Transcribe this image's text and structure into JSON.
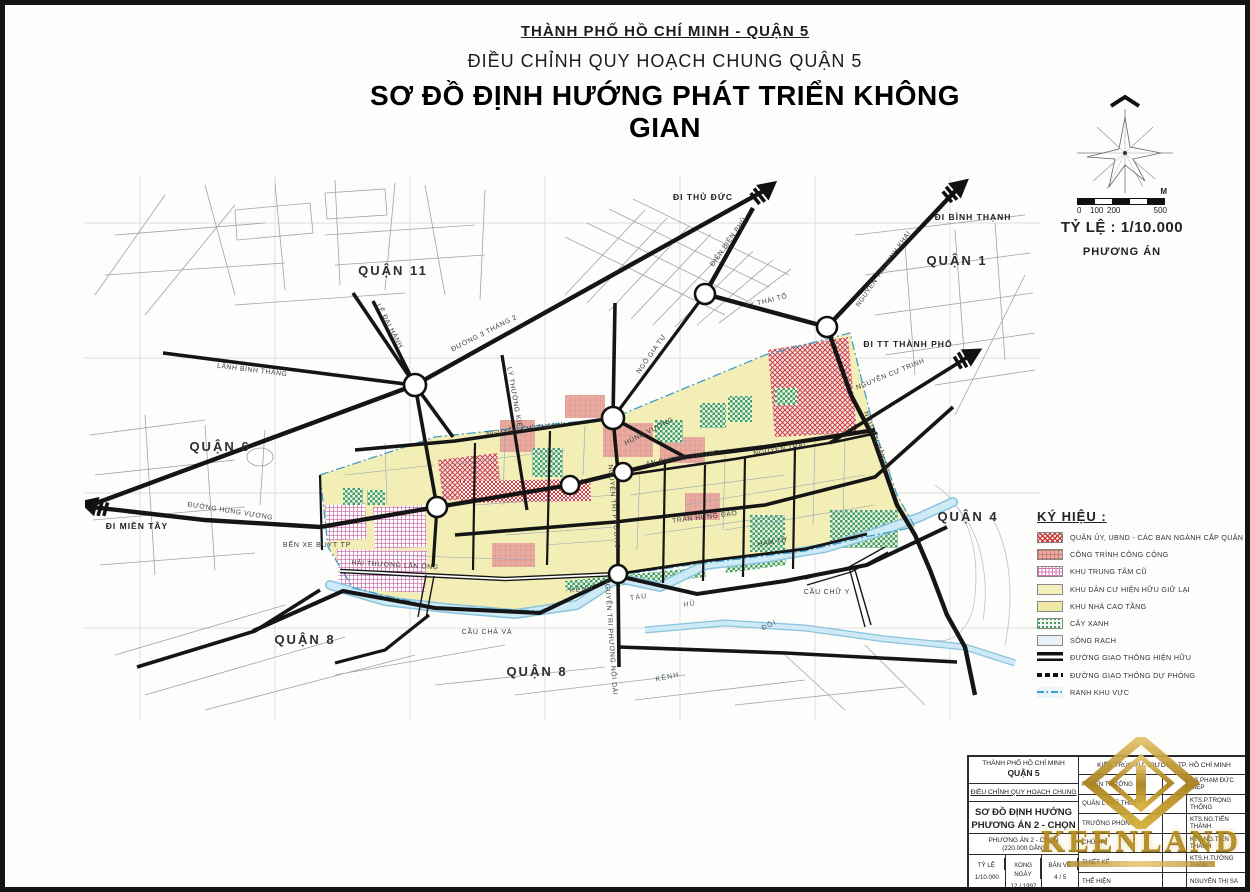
{
  "header": {
    "subtitle": "THÀNH PHỐ HỒ CHÍ MINH - QUẬN 5",
    "project": "ĐIỀU CHỈNH QUY HOẠCH CHUNG QUẬN 5",
    "title": "SƠ ĐỒ ĐỊNH HƯỚNG PHÁT TRIỂN KHÔNG GIAN"
  },
  "scale": {
    "unit": "M",
    "n0": "0",
    "n100": "100",
    "n200": "200",
    "n500": "500",
    "ratio": "TỶ LỆ : 1/10.000",
    "plan": "PHƯƠNG ÁN"
  },
  "map": {
    "districts": [
      {
        "label": "QUẬN 11"
      },
      {
        "label": "QUẬN 1"
      },
      {
        "label": "QUẬN 6"
      },
      {
        "label": "QUẬN 4"
      },
      {
        "label": "QUẬN 8"
      },
      {
        "label": "QUẬN 8"
      }
    ],
    "exits": [
      {
        "label": "ĐI THỦ ĐỨC"
      },
      {
        "label": "ĐI BÌNH THẠNH"
      },
      {
        "label": "ĐI TT THÀNH PHỐ"
      },
      {
        "label": "ĐI MIỀN TÂY"
      }
    ],
    "roads": [
      {
        "label": "LÊ ĐẠI HÀNH"
      },
      {
        "label": "LÃNH BINH THĂNG"
      },
      {
        "label": "ĐƯỜNG 3 THÁNG 2"
      },
      {
        "label": "LÝ THƯỜNG KIỆT"
      },
      {
        "label": "ĐIỆN BIÊN PHỦ"
      },
      {
        "label": "LÝ THÁI TỔ"
      },
      {
        "label": "NGUYỄN THỊ MINH KHAI"
      },
      {
        "label": "NGUYỄN CƯ TRINH"
      },
      {
        "label": "NGUYỄN VĂN CỪ"
      },
      {
        "label": "NGÔ GIA TỰ"
      },
      {
        "label": "NGUYỄN CHÍ THANH"
      },
      {
        "label": "HÙNG VƯƠNG"
      },
      {
        "label": "AN DƯƠNG VƯƠNG"
      },
      {
        "label": "NGUYỄN TRÃI"
      },
      {
        "label": "NGUYỄN TRI PHƯƠNG"
      },
      {
        "label": "TRẦN HƯNG ĐẠO"
      },
      {
        "label": "HẢI THƯỢNG LÃN ÔNG"
      },
      {
        "label": "ĐƯỜNG HÙNG VƯƠNG"
      },
      {
        "label": "HÀM TỬ"
      },
      {
        "label": "NGUYỄN TRI PHƯƠNG NỐI DÀI"
      }
    ],
    "waterways": [
      {
        "label": "KÊNH"
      },
      {
        "label": "TÀU"
      },
      {
        "label": "HỦ"
      },
      {
        "label": "KÊNH"
      },
      {
        "label": "ĐÔI"
      }
    ],
    "bridges": [
      {
        "label": "CẦU CHÀ VÀ"
      },
      {
        "label": "CẦU CHỮ Y"
      }
    ],
    "pois": [
      {
        "label": "BẾN XE BUÝT TP"
      }
    ]
  },
  "legend": {
    "title": "KÝ HIỆU :",
    "items": [
      {
        "label": "QUẬN ỦY, UBND - CÁC BAN NGÀNH CẤP QUẬN"
      },
      {
        "label": "CÔNG TRÌNH CÔNG CỘNG"
      },
      {
        "label": "KHU TRUNG TÂM CŨ"
      },
      {
        "label": "KHU DÂN CƯ HIỆN HỮU GIỮ LẠI"
      },
      {
        "label": "KHU NHÀ CAO TẦNG"
      },
      {
        "label": "CÂY XANH"
      },
      {
        "label": "SÔNG RẠCH"
      },
      {
        "label": "ĐƯỜNG GIAO THÔNG HIỆN HỮU"
      },
      {
        "label": "ĐƯỜNG GIAO THÔNG DỰ PHÓNG"
      },
      {
        "label": "RANH KHU VỰC"
      }
    ]
  },
  "titleblock": {
    "left": {
      "city": "THÀNH PHỐ HỒ CHÍ MINH",
      "district": "QUẬN 5",
      "project": "ĐIỀU CHỈNH QUY HOẠCH CHUNG",
      "sheet_title_1": "SƠ ĐỒ ĐỊNH HƯỚNG",
      "sheet_title_2": "PHƯƠNG ÁN 2 - CHỌN",
      "variant": "PHƯƠNG ÁN 2 - CHỌN",
      "population": "(220.000 DÂN)",
      "scale_label": "TỶ LỆ",
      "scale_value": "1/10.000",
      "date_label": "XONG NGÀY",
      "date_value": "12 / 1997",
      "sheet_label": "BẢN VẼ",
      "sheet_value": "4 / 5"
    },
    "right": {
      "header": "KIẾN TRÚC SƯ TRƯỞNG TP. HỒ CHÍ MINH",
      "rows": [
        {
          "role": "P. VIỆN TRƯỞNG",
          "name": "KS.PHẠM ĐỨC HIỆP"
        },
        {
          "role": "QUẢN LÝ KỸ THUẬT",
          "name": "KTS.P.TRỌNG THỐNG"
        },
        {
          "role": "TRƯỞNG PHÒNG",
          "name": "KTS.NG.TIẾN THÀNH"
        },
        {
          "role": "CHỦ TRÌ",
          "name": "KTS.NG.TIẾN THÀNH"
        },
        {
          "role": "THIẾT KẾ",
          "name": "KTS.H.TƯỜNG THÂN"
        },
        {
          "role": "THỂ HIỆN",
          "name": "NGUYỄN THỊ SA"
        }
      ]
    }
  },
  "watermark": {
    "text": "KEENLAND"
  },
  "colors": {
    "residential_yellow": "#f3eeb6",
    "public_salmon": "#e9aba1",
    "committee_red": "#c43131",
    "old_center_pink": "#d178ae",
    "green": "#3f9e5a",
    "canal_blue": "#bfe3f2",
    "boundary_cyan": "#3f9ecb",
    "road_black": "#151515",
    "watermark_gold": "#b38a1e"
  }
}
